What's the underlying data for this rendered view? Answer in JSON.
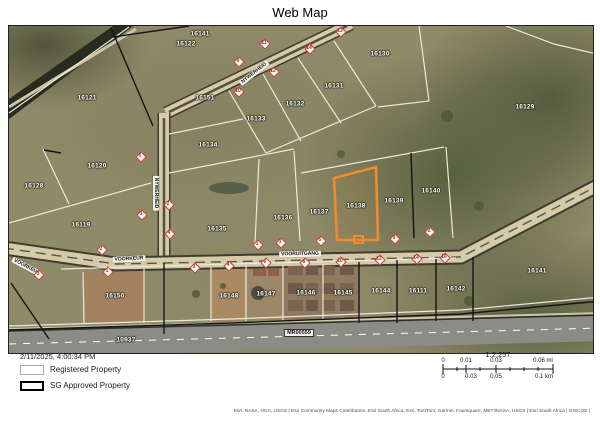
{
  "title": "Web Map",
  "map": {
    "highlighted_parcel": "16138",
    "parcels": [
      {
        "id": "16141",
        "x": 191,
        "y": 8
      },
      {
        "id": "16122",
        "x": 177,
        "y": 18
      },
      {
        "id": "16130",
        "x": 371,
        "y": 28
      },
      {
        "id": "16121",
        "x": 78,
        "y": 72
      },
      {
        "id": "16151",
        "x": 196,
        "y": 72
      },
      {
        "id": "16131",
        "x": 325,
        "y": 60
      },
      {
        "id": "16132",
        "x": 286,
        "y": 78
      },
      {
        "id": "16133",
        "x": 247,
        "y": 93
      },
      {
        "id": "16129",
        "x": 516,
        "y": 81
      },
      {
        "id": "16134",
        "x": 199,
        "y": 119
      },
      {
        "id": "16120",
        "x": 88,
        "y": 140
      },
      {
        "id": "16128",
        "x": 25,
        "y": 160
      },
      {
        "id": "16119",
        "x": 72,
        "y": 199
      },
      {
        "id": "16135",
        "x": 208,
        "y": 203
      },
      {
        "id": "16136",
        "x": 274,
        "y": 192
      },
      {
        "id": "16137",
        "x": 310,
        "y": 186
      },
      {
        "id": "16138",
        "x": 347,
        "y": 180
      },
      {
        "id": "16139",
        "x": 385,
        "y": 175
      },
      {
        "id": "16140",
        "x": 422,
        "y": 165
      },
      {
        "id": "16150",
        "x": 106,
        "y": 270
      },
      {
        "id": "16148",
        "x": 220,
        "y": 270
      },
      {
        "id": "16147",
        "x": 257,
        "y": 268
      },
      {
        "id": "16146",
        "x": 297,
        "y": 267
      },
      {
        "id": "16145",
        "x": 334,
        "y": 267
      },
      {
        "id": "16144",
        "x": 372,
        "y": 265
      },
      {
        "id": "16111",
        "x": 409,
        "y": 265
      },
      {
        "id": "16142",
        "x": 447,
        "y": 263
      },
      {
        "id": "16141",
        "x": 528,
        "y": 245
      },
      {
        "id": "10937",
        "x": 117,
        "y": 314
      }
    ],
    "roads": [
      {
        "name": "NYWERHEID",
        "x": 245,
        "y": 47,
        "angle": -38
      },
      {
        "name": "NYWERHEID",
        "x": 147,
        "y": 167,
        "angle": 90
      },
      {
        "name": "VOORKEUR",
        "x": 18,
        "y": 241,
        "angle": 28
      },
      {
        "name": "VOORKEUR",
        "x": 120,
        "y": 233,
        "angle": -3
      },
      {
        "name": "VOORUITGANG",
        "x": 291,
        "y": 228,
        "angle": -1
      }
    ],
    "route_marker": {
      "name": "MR00559",
      "x": 290,
      "y": 307
    },
    "stand_numbers": [
      {
        "n": "9",
        "x": 229,
        "y": 35
      },
      {
        "n": "11",
        "x": 255,
        "y": 17
      },
      {
        "n": "13",
        "x": 331,
        "y": 5
      },
      {
        "n": "10",
        "x": 229,
        "y": 65
      },
      {
        "n": "12",
        "x": 264,
        "y": 45
      },
      {
        "n": "14",
        "x": 300,
        "y": 22
      },
      {
        "n": "5",
        "x": 131,
        "y": 130
      },
      {
        "n": "3",
        "x": 132,
        "y": 188
      },
      {
        "n": "2",
        "x": 159,
        "y": 178
      },
      {
        "n": "4",
        "x": 160,
        "y": 207
      },
      {
        "n": "2",
        "x": 92,
        "y": 223
      },
      {
        "n": "3",
        "x": 29,
        "y": 248
      },
      {
        "n": "1",
        "x": 98,
        "y": 245
      },
      {
        "n": "2",
        "x": 185,
        "y": 241
      },
      {
        "n": "4",
        "x": 219,
        "y": 239
      },
      {
        "n": "6",
        "x": 256,
        "y": 236
      },
      {
        "n": "8",
        "x": 295,
        "y": 236
      },
      {
        "n": "10",
        "x": 331,
        "y": 235
      },
      {
        "n": "12",
        "x": 370,
        "y": 233
      },
      {
        "n": "14",
        "x": 407,
        "y": 232
      },
      {
        "n": "16",
        "x": 435,
        "y": 231
      },
      {
        "n": "1",
        "x": 248,
        "y": 218
      },
      {
        "n": "3",
        "x": 271,
        "y": 216
      },
      {
        "n": "5",
        "x": 311,
        "y": 214
      },
      {
        "n": "9",
        "x": 385,
        "y": 212
      },
      {
        "n": "2",
        "x": 420,
        "y": 205
      }
    ]
  },
  "footer": {
    "timestamp": "2/11/2025, 4:00:34 PM",
    "legend": [
      {
        "label": "Registered Property"
      },
      {
        "label": "SG Approved Property"
      }
    ],
    "scale_ratio": "1:2,257",
    "scalebar_mi": [
      {
        "t": "0",
        "x": 443
      },
      {
        "t": "0.01",
        "x": 466
      },
      {
        "t": "0.03",
        "x": 496
      },
      {
        "t": "0.06 mi",
        "x": 543
      }
    ],
    "scalebar_km": [
      {
        "t": "0",
        "x": 443
      },
      {
        "t": "0.03",
        "x": 471
      },
      {
        "t": "0.05",
        "x": 496
      },
      {
        "t": "0.1 km",
        "x": 544
      }
    ],
    "attribution": "Esri, NASA, NGA, USGS | Esri Community Maps Contributors, Esri South Africa, Esri, TomTom, Garmin, Foursquare, METI/NASA, USGS | Esri South Africa | GISCOE |"
  },
  "colors": {
    "highlight": "#ef8b30",
    "stand_number": "#b02a22",
    "road_fill": "#d6cba8",
    "terrain": "#8f8a68"
  }
}
